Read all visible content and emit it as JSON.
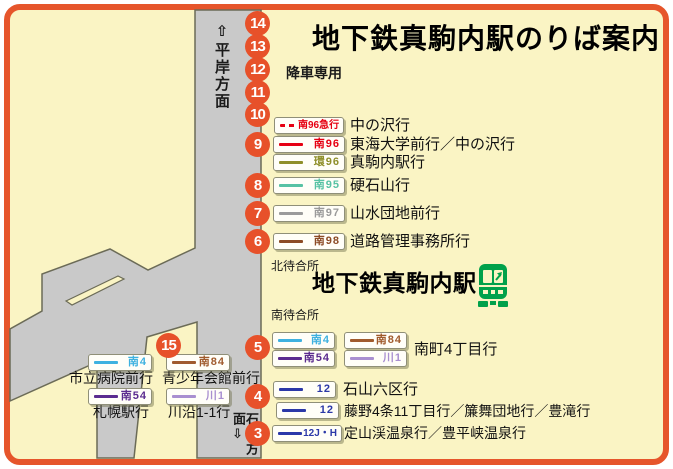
{
  "title": "地下鉄真駒内駅のりば案内",
  "station": {
    "name": "地下鉄真駒内駅",
    "north_waiting": "北待合所",
    "south_waiting": "南待合所"
  },
  "roads": {
    "north_direction": "⇧平岸方面",
    "south_direction": "石山方面⇩",
    "drop_off_note": "降車専用"
  },
  "stops": {
    "s3": "3",
    "s4": "4",
    "s5": "5",
    "s6": "6",
    "s7": "7",
    "s8": "8",
    "s9": "9",
    "s10": "10",
    "s11": "11",
    "s12": "12",
    "s13": "13",
    "s14": "14",
    "s15": "15"
  },
  "colors": {
    "accent_orange": "#e7512a",
    "map_background": "#faf4c4",
    "road_fill": "#c9c9c9",
    "road_outline": "#6b6b57",
    "badge_red": "#e60012",
    "badge_olive": "#8f8f2a",
    "badge_teal": "#57c2a4",
    "badge_gray": "#9b9b9b",
    "badge_dark_brown": "#8c4b26",
    "badge_light_blue": "#3eb1e0",
    "badge_brown": "#a05a2d",
    "badge_purple": "#5b2c8f",
    "badge_lavender": "#a98fd0",
    "badge_blue": "#2b38a8",
    "train_green": "#00a14b"
  },
  "badges": {
    "m96exp": {
      "code": "南96急行",
      "dest": "中の沢行",
      "color": "#e60012",
      "line_style": "dashed"
    },
    "m96": {
      "code": "南96",
      "dest": "東海大学前行／中の沢行",
      "color": "#e60012",
      "line_style": "solid"
    },
    "k96": {
      "code": "環96",
      "dest": "真駒内駅行",
      "color": "#8f8f2a",
      "line_style": "solid"
    },
    "m95": {
      "code": "南95",
      "dest": "硬石山行",
      "color": "#57c2a4",
      "line_style": "solid"
    },
    "m97": {
      "code": "南97",
      "dest": "山水団地前行",
      "color": "#9b9b9b",
      "line_style": "solid"
    },
    "m98": {
      "code": "南98",
      "dest": "道路管理事務所行",
      "color": "#8c4b26",
      "line_style": "solid"
    },
    "m4_east": {
      "code": "南4",
      "color": "#3eb1e0",
      "line_style": "solid"
    },
    "m84_east": {
      "code": "南84",
      "color": "#a05a2d",
      "line_style": "solid"
    },
    "m54_east": {
      "code": "南54",
      "color": "#5b2c8f",
      "line_style": "solid"
    },
    "k1_east": {
      "code": "川1",
      "color": "#a98fd0",
      "line_style": "solid"
    },
    "dest_stop5": "南町4丁目行",
    "r12_a": {
      "code": "12",
      "dest": "石山六区行",
      "color": "#2b38a8",
      "line_style": "solid"
    },
    "r12_b": {
      "code": "12",
      "dest": "藤野4条11丁目行／簾舞団地行／豊滝行",
      "color": "#2b38a8",
      "line_style": "solid"
    },
    "r12_jh": {
      "code": "12J・H",
      "dest": "定山渓温泉行／豊平峡温泉行",
      "color": "#2b38a8",
      "line_style": "solid"
    },
    "m4_west": {
      "code": "南4",
      "dest": "市立病院前行",
      "color": "#3eb1e0",
      "line_style": "solid"
    },
    "m84_west": {
      "code": "南84",
      "dest": "青少年会館前行",
      "color": "#a05a2d",
      "line_style": "solid"
    },
    "m54_west": {
      "code": "南54",
      "dest": "札幌駅行",
      "color": "#5b2c8f",
      "line_style": "solid"
    },
    "k1_west": {
      "code": "川1",
      "dest": "川沿1-1行",
      "color": "#a98fd0",
      "line_style": "solid"
    }
  }
}
